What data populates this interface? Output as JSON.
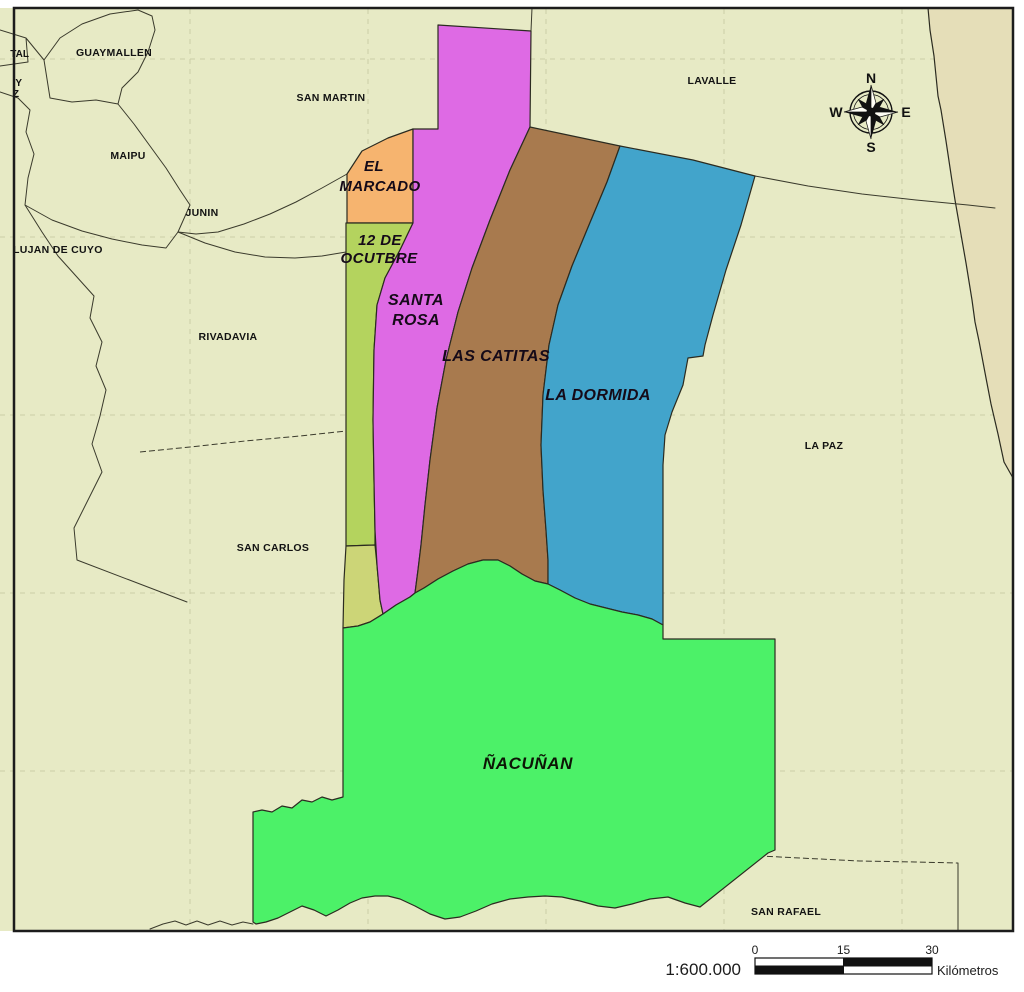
{
  "colors": {
    "background": "#e7eac5",
    "east_province": "#e5deb8",
    "frame": "#1c1c1c"
  },
  "neighbors": {
    "capital_fragment": "TAL",
    "godoy_fragment_1": "Y",
    "godoy_fragment_2": "Z",
    "guaymallen": "GUAYMALLEN",
    "san_martin": "SAN MARTIN",
    "lavalle": "LAVALLE",
    "maipu": "MAIPU",
    "junin": "JUNIN",
    "lujan_de_cuyo": "LUJAN DE CUYO",
    "rivadavia": "RIVADAVIA",
    "san_carlos": "SAN CARLOS",
    "la_paz": "LA PAZ",
    "san_rafael": "SAN RAFAEL"
  },
  "districts": {
    "el_marcado": {
      "line1": "EL",
      "line2": "MARCADO",
      "color": "#f6b46f"
    },
    "doce_de_ocutbre": {
      "line1": "12 DE",
      "line2": "OCUTBRE",
      "color": "#b4d35e",
      "south_color": "#ccd577"
    },
    "santa_rosa": {
      "line1": "SANTA",
      "line2": "ROSA",
      "color": "#de6ae4"
    },
    "las_catitas": {
      "label": "LAS CATITAS",
      "color": "#a87a4e"
    },
    "la_dormida": {
      "label": "LA DORMIDA",
      "color": "#42a4cb"
    },
    "nacunan": {
      "label": "ÑACUÑAN",
      "color": "#4cf168"
    }
  },
  "compass": {
    "north": "N",
    "east": "E",
    "south": "S",
    "west": "W"
  },
  "scalebar": {
    "ratio": "1:600.000",
    "tick0": "0",
    "tick15": "15",
    "tick30": "30",
    "unit": "Kilómetros"
  }
}
